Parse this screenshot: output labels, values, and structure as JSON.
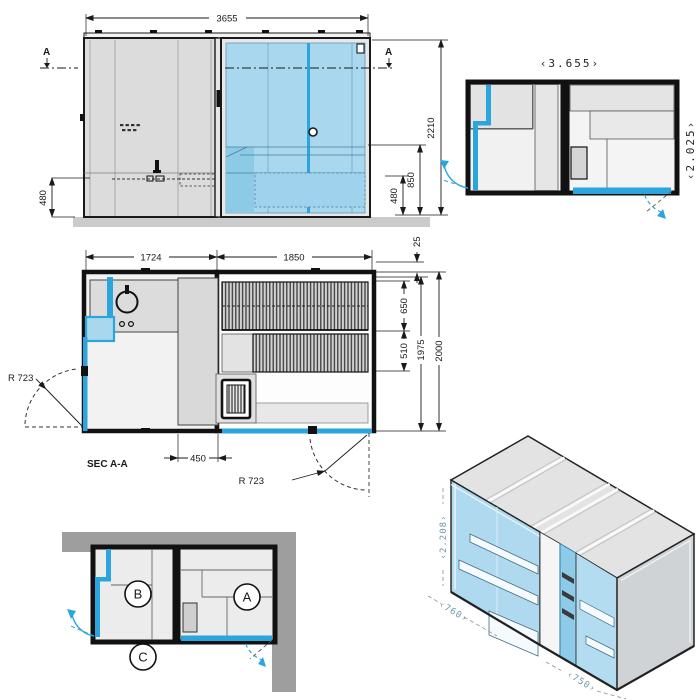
{
  "colors": {
    "accent": "#2aa5dd",
    "glass": "#a9d7ee",
    "panel": "#dcdcdc",
    "outline": "#1a1a1a",
    "context_wall": "#9e9e9e",
    "ground": "#cbcbcb"
  },
  "elevation": {
    "dim_width": "3655",
    "dim_height": "2210",
    "dim_bench": "850",
    "dim_step": "480",
    "dim_step_left": "480",
    "section_a_left": "A",
    "section_a_right": "A"
  },
  "plan_small": {
    "dim_width": "‹3.655›",
    "dim_depth": "‹2.025›"
  },
  "plan_section": {
    "label": "SEC A-A",
    "dim_room_left": "1724",
    "dim_room_right": "1850",
    "dim_wall": "25",
    "dim_bench_upper": "650",
    "dim_bench_lower": "510",
    "dim_inner": "1975",
    "dim_outer": "2000",
    "dim_cabinet": "450",
    "radius_left": "R 723",
    "radius_right": "R 723"
  },
  "plan_context": {
    "room_a": "A",
    "room_b": "B",
    "room_c": "C"
  },
  "iso": {
    "dim_height": "‹2.208›",
    "dim_door_left": "‹760›",
    "dim_door_right": "‹750›"
  }
}
